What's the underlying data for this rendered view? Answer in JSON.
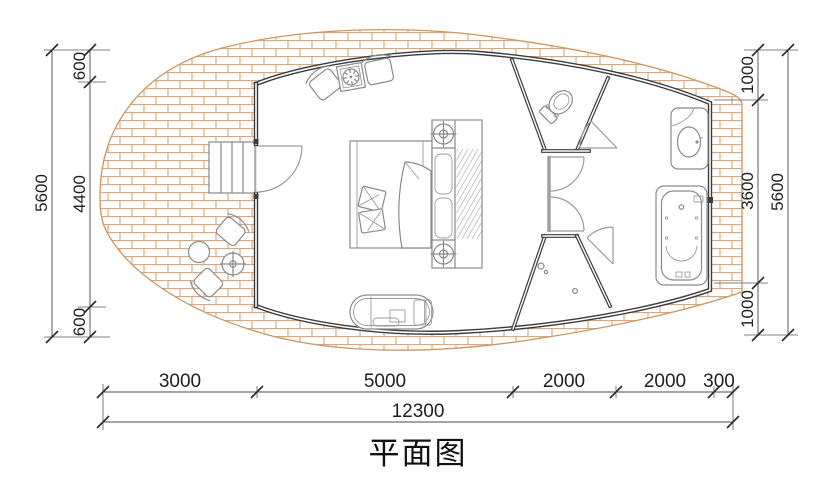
{
  "title": "平面图",
  "dimensions": {
    "left": {
      "total": "5600",
      "segments": [
        "600",
        "4400",
        "600"
      ]
    },
    "right": {
      "total": "5600",
      "segments": [
        "1000",
        "3600",
        "1000"
      ]
    },
    "bottom": {
      "total": "12300",
      "segments": [
        "3000",
        "5000",
        "2000",
        "2000",
        "300"
      ]
    }
  },
  "colors": {
    "brick_line": "#dfa678",
    "deck_outline": "#d2945e",
    "wall": "#3c3c3c",
    "partition_gray": "#9f9f9f",
    "furniture_line": "#8a8a8a",
    "dimension_line": "#4a4a4a",
    "text": "#1f1f1f",
    "background": "#ffffff"
  },
  "furniture_symbols": [
    "entry-steps",
    "outdoor-chair",
    "outdoor-chair",
    "round-table",
    "side-table",
    "armchair",
    "stove-table",
    "armchair",
    "double-bed",
    "pillows",
    "blanket",
    "wardrobe",
    "downlight",
    "downlight",
    "chaise-bench",
    "toilet",
    "washbasin",
    "bathtub",
    "shower-drain"
  ]
}
